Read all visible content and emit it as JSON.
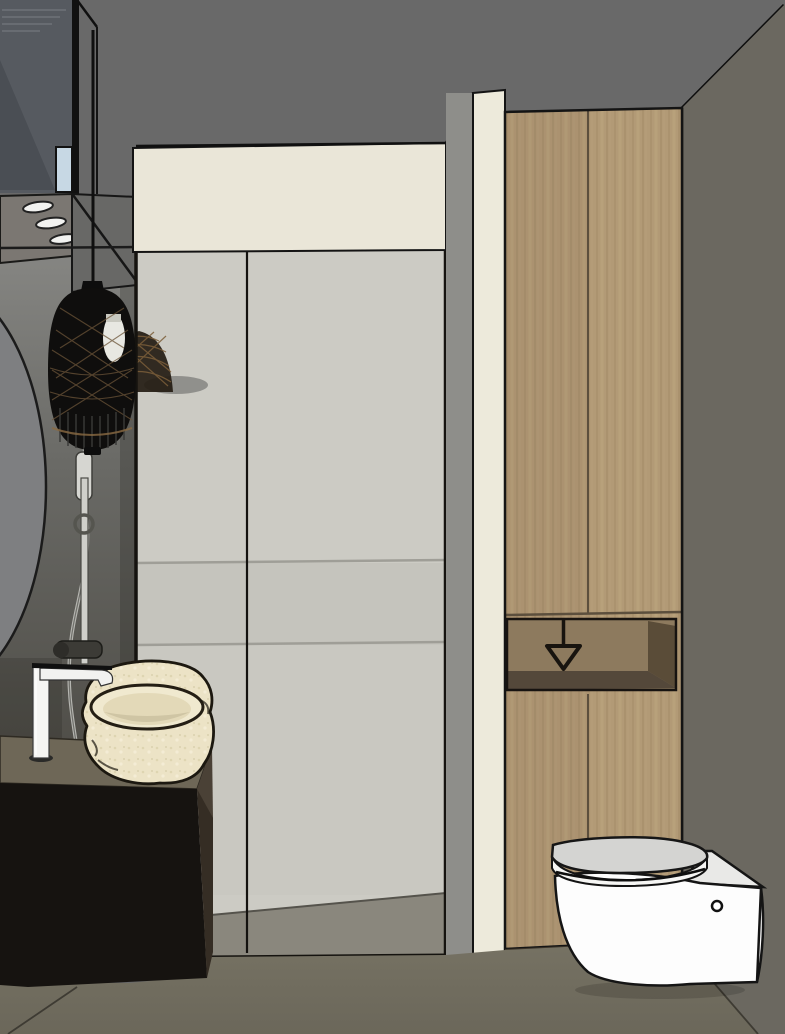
{
  "scene": {
    "title": "3D bathroom interior rendering",
    "style": "SketchUp-style architectural visualization, no visible text",
    "objects": [
      {
        "id": "ceiling",
        "label": "gray ceiling plane"
      },
      {
        "id": "right-wall",
        "label": "warm gray right wall"
      },
      {
        "id": "left-wall",
        "label": "shadowed left wall"
      },
      {
        "id": "round-mirror",
        "label": "edge of round wall mirror"
      },
      {
        "id": "floating-shelf-unit",
        "label": "suspended dark shelf unit, top left"
      },
      {
        "id": "spotlight-rings",
        "label": "three recessed spotlight trims on shelf underside"
      },
      {
        "id": "window-strip",
        "label": "small light blue glass strip"
      },
      {
        "id": "pendant-light",
        "label": "black woven rattan pendant lamp with exposed bulb"
      },
      {
        "id": "pendant-reflection",
        "label": "woven lamp reflection on shower glass"
      },
      {
        "id": "shower-bulkhead",
        "label": "cream wall band above shower glass"
      },
      {
        "id": "cream-pillar",
        "label": "cream wall pillar beside shower"
      },
      {
        "id": "shower-glass",
        "label": "framed glass shower enclosure with center seam"
      },
      {
        "id": "shower-back-wall",
        "label": "light tiled back wall seen through glass"
      },
      {
        "id": "shower-floor",
        "label": "gray shower tray floor"
      },
      {
        "id": "shower-rail",
        "label": "shower slide rail with hand shower"
      },
      {
        "id": "shower-mixer",
        "label": "dark shower mixer valve"
      },
      {
        "id": "shower-hose",
        "label": "flexible shower hose"
      },
      {
        "id": "wood-cabinet",
        "label": "tall oak storage cabinet"
      },
      {
        "id": "cabinet-niche",
        "label": "open niche in cabinet"
      },
      {
        "id": "paper-holder-symbol",
        "label": "toilet-paper holder arrow symbol in niche"
      },
      {
        "id": "toilet",
        "label": "white wall-hung toilet"
      },
      {
        "id": "toilet-button",
        "label": "small round opening on toilet side"
      },
      {
        "id": "vanity-cabinet",
        "label": "black vanity cabinet"
      },
      {
        "id": "countertop",
        "label": "dark taupe countertop"
      },
      {
        "id": "stone-sink",
        "label": "rough cream stone vessel sink"
      },
      {
        "id": "faucet",
        "label": "white single-lever basin faucet"
      },
      {
        "id": "floor",
        "label": "taupe gray floor"
      }
    ],
    "palette": {
      "ceiling": "#696969",
      "right_wall": "#6b6860",
      "left_wall_top": "#8d8d8a",
      "left_wall_bottom": "#4c4a44",
      "mirror": "#7e7f81",
      "cream_band": "#eae6d8",
      "cream_pillar": "#edeadb",
      "glass_back_wall": "#cccbc4",
      "glass_frame": "#15130f",
      "wood": "#b29a76",
      "wood_seam": "#5c4f3d",
      "niche_shadow": "#54483a",
      "floor": "#716d5f",
      "shower_floor": "#8a877d",
      "vanity_black": "#161310",
      "counter": "#6e6757",
      "counter_side": "#4a4136",
      "sink_stone": "#ece3c6",
      "fixture_white": "#f5f5f3",
      "toilet_white": "#fdfdfd",
      "toilet_seat_top": "#d4d4d2",
      "pendant_black": "#0f0e0d",
      "bulb": "#e8e8e2",
      "rattan_brown": "#7d5f3a",
      "window_blue": "#c7d8e4"
    }
  }
}
